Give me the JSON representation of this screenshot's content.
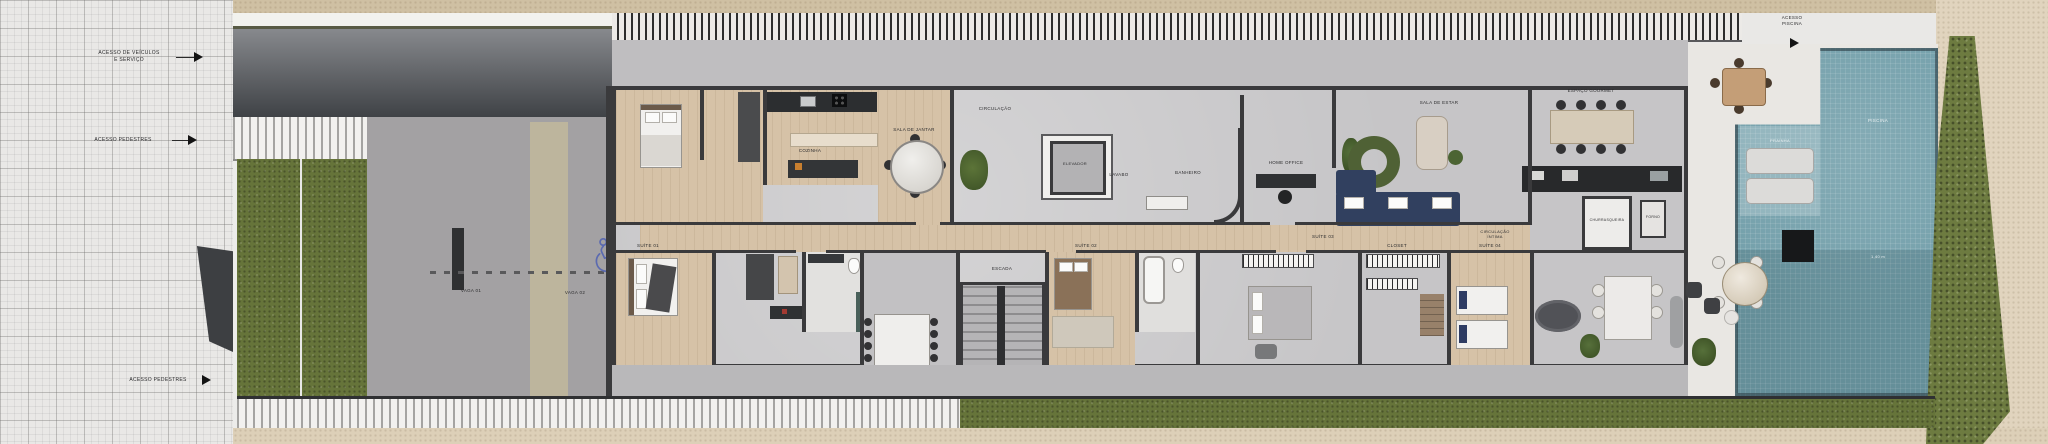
{
  "street": {
    "access_vehicles_line1": "ACESSO DE VEÍCULOS",
    "access_vehicles_line2": "E SERVIÇO",
    "access_pedestrian_top": "ACESSO PEDESTRES",
    "access_pedestrian_bottom": "ACESSO PEDESTRES"
  },
  "parking": {
    "spot1": "VAGA 01",
    "spot2": "VAGA 02"
  },
  "rooms": {
    "kitchen": "COZINHA",
    "dining": "SALA DE JANTAR",
    "hall": "CIRCULAÇÃO",
    "elevator": "ELEVADOR",
    "powder": "LAVABO",
    "bath": "BANHEIRO",
    "office": "HOME OFFICE",
    "living": "SALA DE ESTAR",
    "gourmet": "ESPAÇO GOURMET",
    "grill": "CHURRASQUEIRA",
    "oven": "FORNO",
    "closet": "CLOSET",
    "suite1": "SUÍTE 01",
    "suite2": "SUÍTE 02",
    "suite3": "SUÍTE 03",
    "suite4": "SUÍTE 04",
    "intimate_hall_line1": "CIRCULAÇÃO",
    "intimate_hall_line2": "ÍNTIMA",
    "stairs": "ESCADA"
  },
  "pool_area": {
    "access_line1": "ACESSO",
    "access_line2": "PISCINA",
    "pool_label": "PISCINA",
    "ledge_label": "PRAINHA",
    "depth_label": "1,40 m"
  },
  "colors": {
    "sofa_navy": "#31405f",
    "pool_water": "#74a0ab",
    "grass_green": "#66743a",
    "wheelchair_blue": "#5b6ab0"
  }
}
